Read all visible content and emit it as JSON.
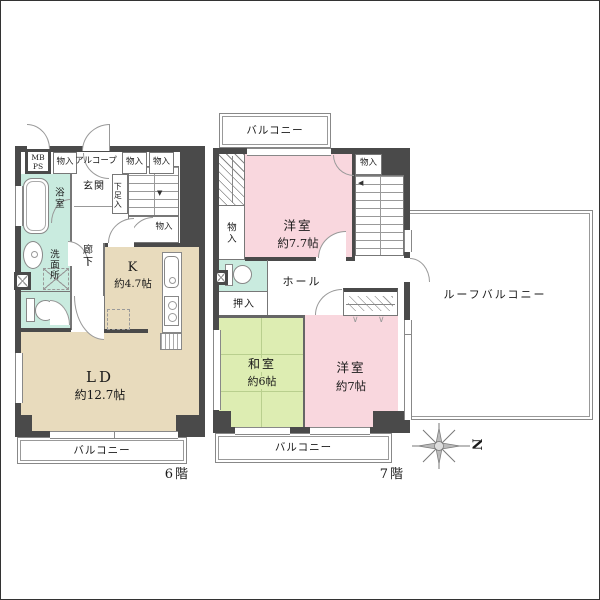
{
  "f6": {
    "floor_label": "6階",
    "balcony": "バルコニー",
    "mb": "MB",
    "ps": "PS",
    "storage1": "物入",
    "alcove": "アルコープ",
    "storage2": "物入",
    "storage3": "物入",
    "bath": "浴室",
    "entrance": "玄関",
    "shoes": "下足入",
    "storage4": "物入",
    "washroom": "洗面所",
    "corridor": "廊下",
    "kitchen_name": "K",
    "kitchen_size": "約4.7帖",
    "ld_name": "LD",
    "ld_size": "約12.7帖"
  },
  "f7": {
    "floor_label": "7階",
    "balcony_top": "バルコニー",
    "balcony_bottom": "バルコニー",
    "roof_balcony": "ルーフバルコニー",
    "western1_name": "洋室",
    "western1_size": "約7.7帖",
    "storage_top": "物入",
    "storage_left": "物入",
    "hall": "ホール",
    "closet": "押入",
    "japanese_name": "和室",
    "japanese_size": "約6帖",
    "western2_name": "洋室",
    "western2_size": "約7帖"
  },
  "compass": {
    "north": "N"
  },
  "colors": {
    "wall": "#4a4a4a",
    "wet_room": "#c9ebdf",
    "wood_room": "#e8dbbd",
    "western_room": "#f9d7de",
    "tatami_room": "#ddedb2"
  }
}
